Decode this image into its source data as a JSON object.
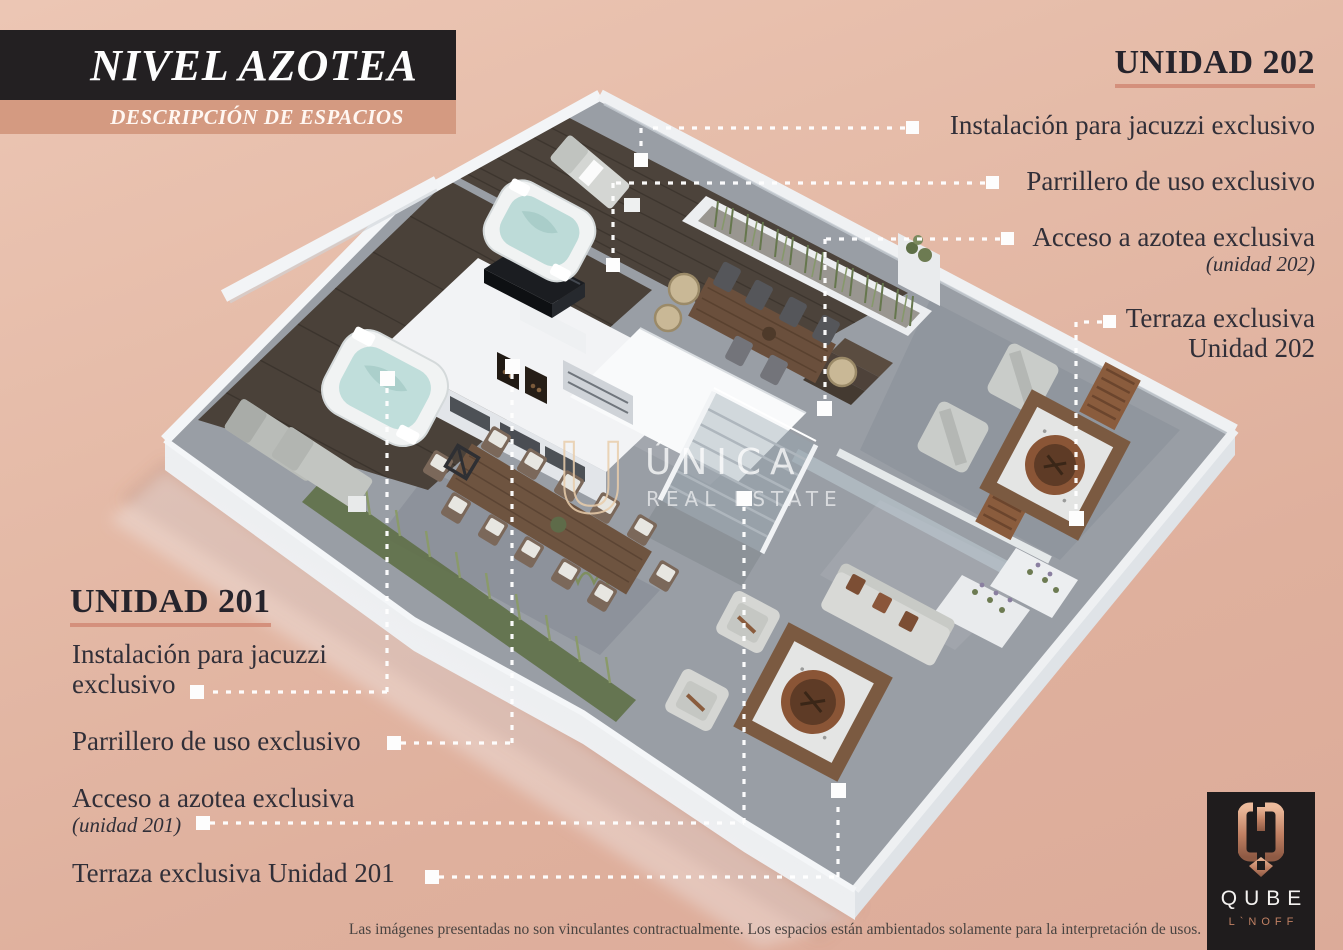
{
  "title_block": {
    "title": "NIVEL AZOTEA",
    "subtitle": "DESCRIPCIÓN DE ESPACIOS"
  },
  "unit_202": {
    "heading": "UNIDAD 202",
    "labels": [
      {
        "text": "Instalación para jacuzzi exclusivo"
      },
      {
        "text": "Parrillero de uso exclusivo"
      },
      {
        "text": "Acceso a azotea exclusiva",
        "note": "(unidad 202)"
      },
      {
        "text": "Terraza exclusiva",
        "text2": "Unidad 202"
      }
    ]
  },
  "unit_201": {
    "heading": "UNIDAD 201",
    "labels": [
      {
        "text": "Instalación para jacuzzi",
        "text2": "exclusivo"
      },
      {
        "text": "Parrillero de uso exclusivo"
      },
      {
        "text": "Acceso a azotea exclusiva",
        "note": "(unidad 201)"
      },
      {
        "text": "Terraza exclusiva Unidad 201"
      }
    ]
  },
  "watermark": {
    "initial": "U",
    "name": "ÚNICA",
    "tagline": "REAL ESTATE"
  },
  "logo": {
    "brand": "QUBE",
    "sub": "L`NOFF"
  },
  "disclaimer": "Las imágenes presentadas no son vinculantes contractualmente. Los espacios están ambientados solamente para la interpretación de usos.",
  "colors": {
    "background": "#e2b4a1",
    "title_bar": "#232022",
    "accent_bar": "#d49a81",
    "heading_underline": "#d4907c",
    "label_text": "#312f38",
    "leader_line": "#ffffff",
    "deck_wood": "#4c433b",
    "tile_gray": "#999ea5",
    "water": "#c0dedb",
    "logo_bg": "#1f1c1d",
    "logo_copper": "#c08063"
  }
}
